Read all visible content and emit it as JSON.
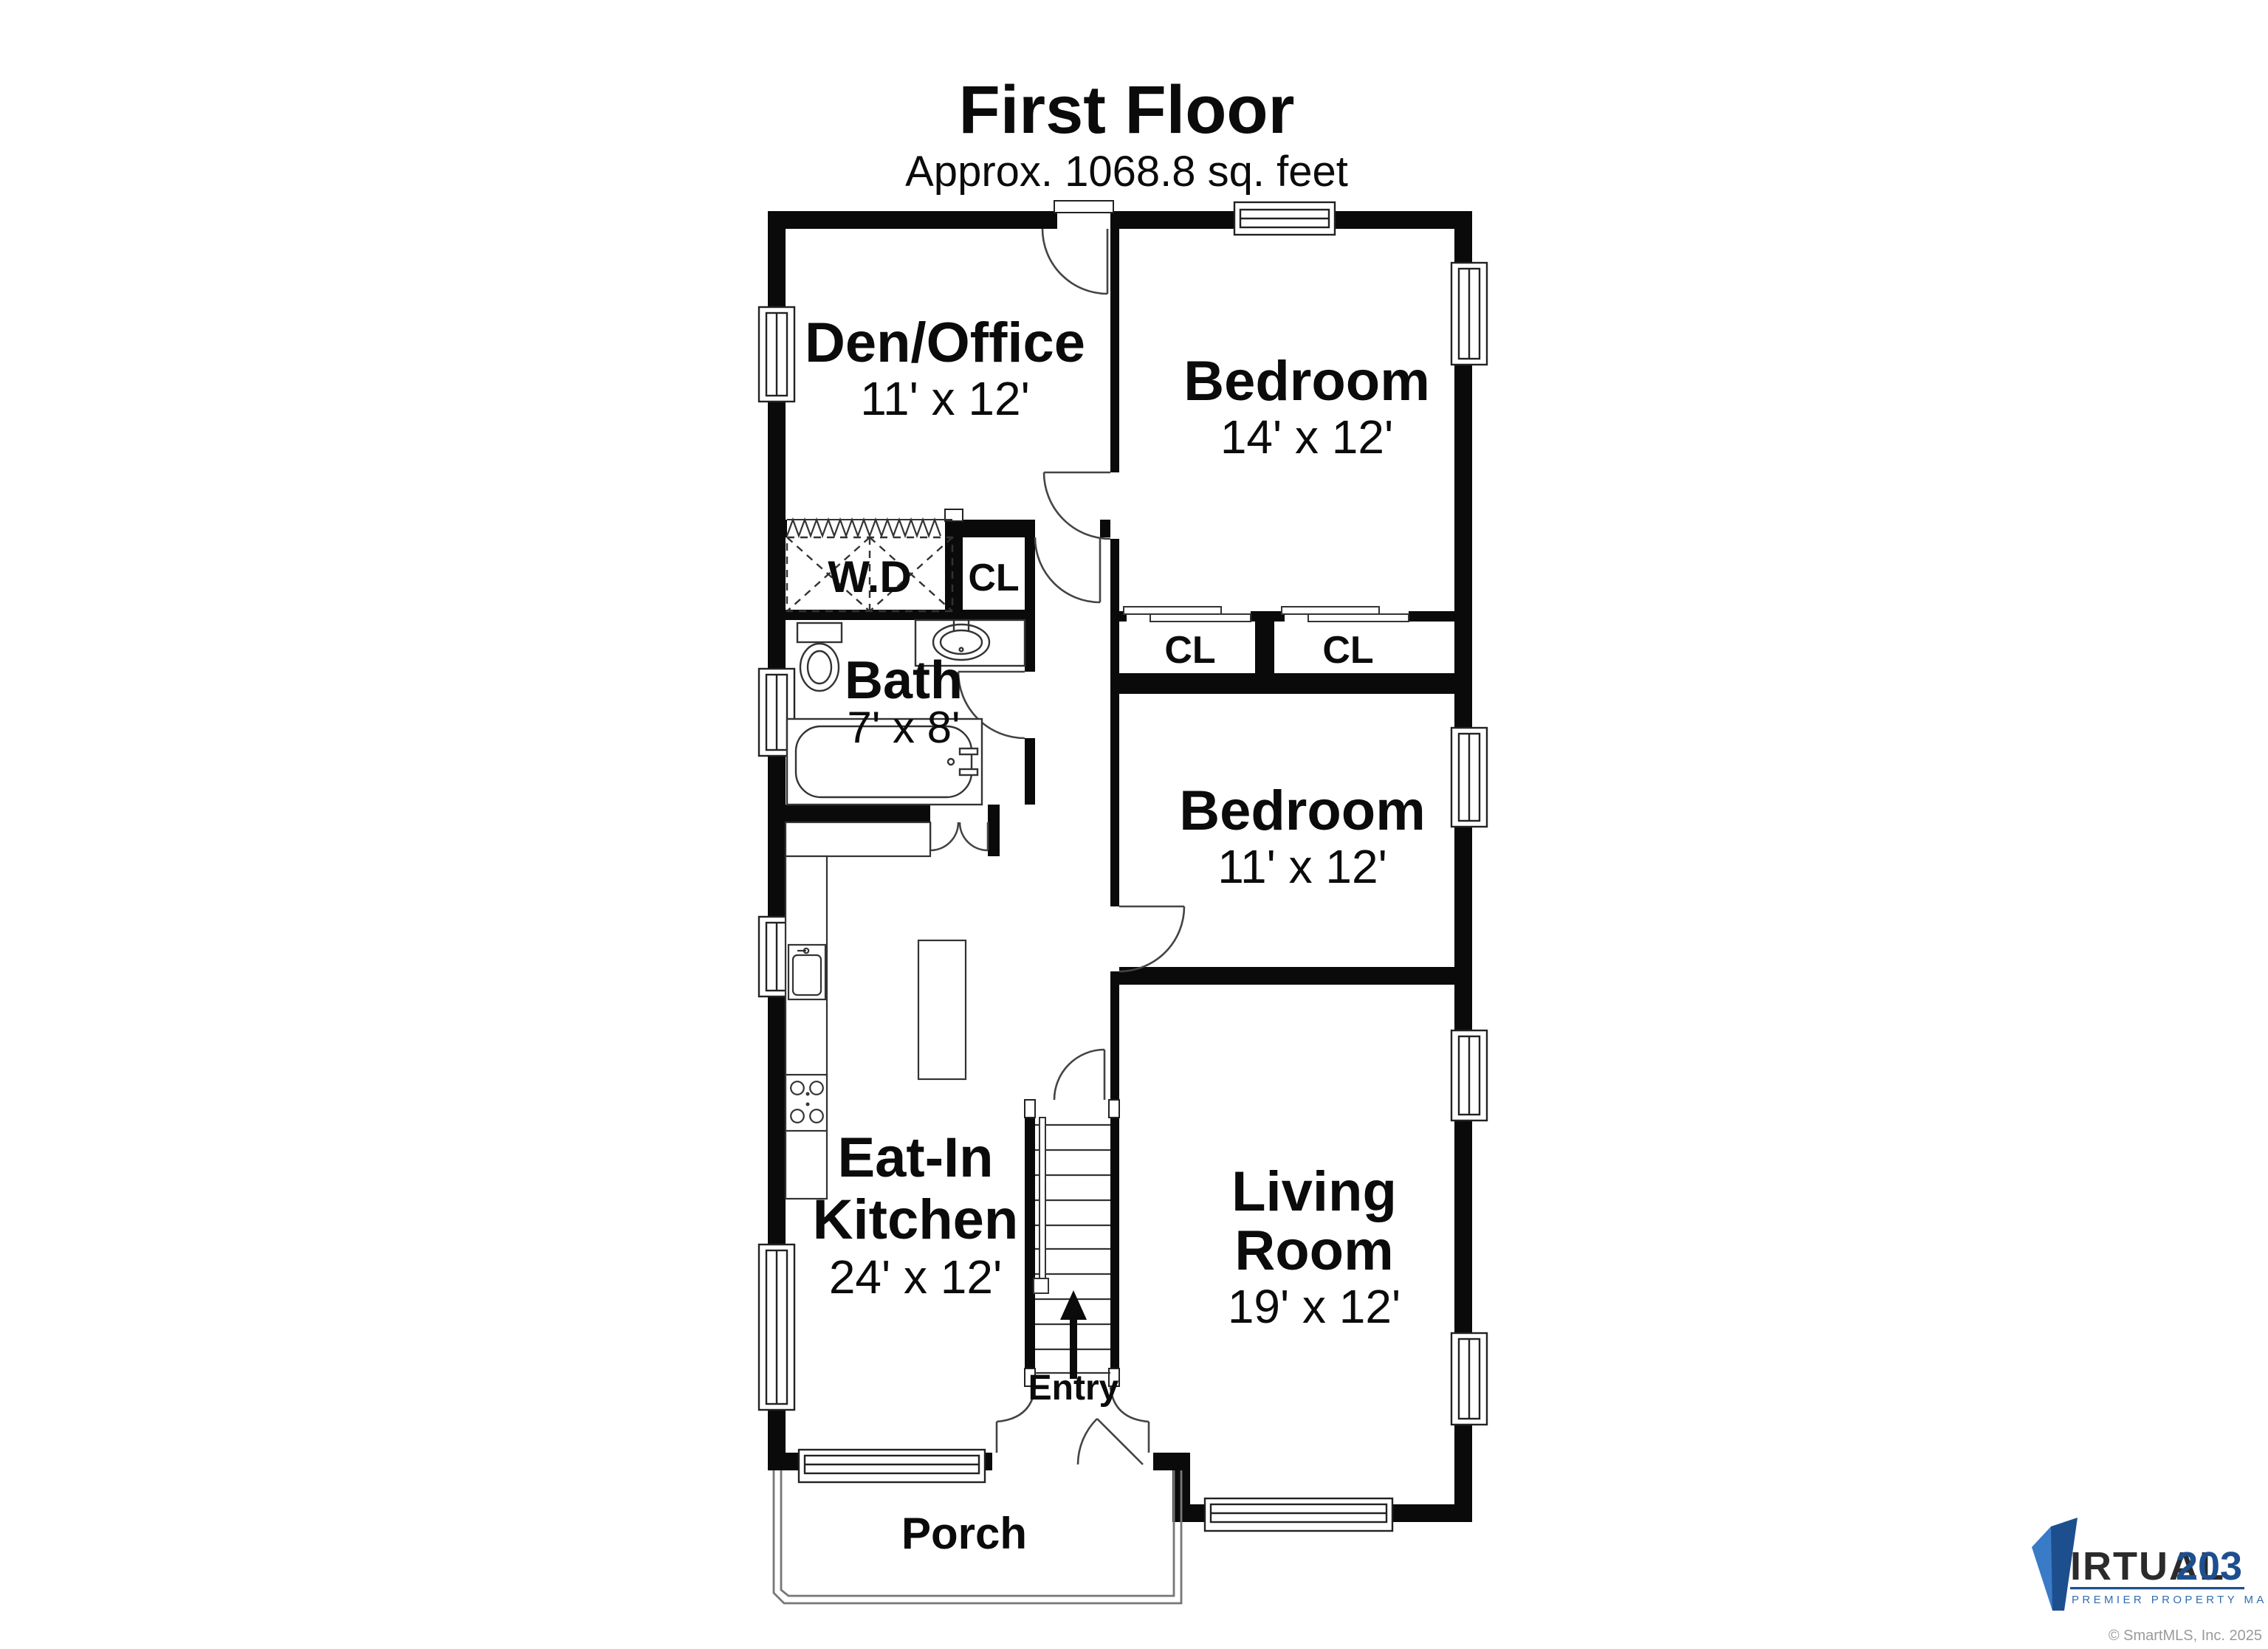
{
  "floor": {
    "title": "First Floor",
    "area": "Approx. 1068.8 sq. feet"
  },
  "rooms": {
    "den": {
      "name": "Den/Office",
      "dims": "11' x 12'"
    },
    "bedroom1": {
      "name": "Bedroom",
      "dims": "14' x 12'"
    },
    "wd": {
      "name": "W.D"
    },
    "closet_hall": {
      "name": "CL"
    },
    "bath": {
      "name": "Bath",
      "dims": "7' x 8'"
    },
    "closet_a": {
      "name": "CL"
    },
    "closet_b": {
      "name": "CL"
    },
    "bedroom2": {
      "name": "Bedroom",
      "dims": "11' x 12'"
    },
    "kitchen": {
      "line1": "Eat-In",
      "line2": "Kitchen",
      "dims": "24' x 12'"
    },
    "living": {
      "line1": "Living",
      "line2": "Room",
      "dims": "19' x 12'"
    },
    "entry": {
      "name": "Entry"
    },
    "porch": {
      "name": "Porch"
    }
  },
  "branding": {
    "logo_text": "IRTUAL",
    "logo_number": "203",
    "tagline": "PREMIER PROPERTY MARKETING",
    "copyright": "© SmartMLS, Inc. 2025",
    "colors": {
      "light_blue": "#3a7bc8",
      "navy": "#1d4f8f",
      "dark_text": "#2b2b2b",
      "gray": "#9a9a9a"
    }
  }
}
